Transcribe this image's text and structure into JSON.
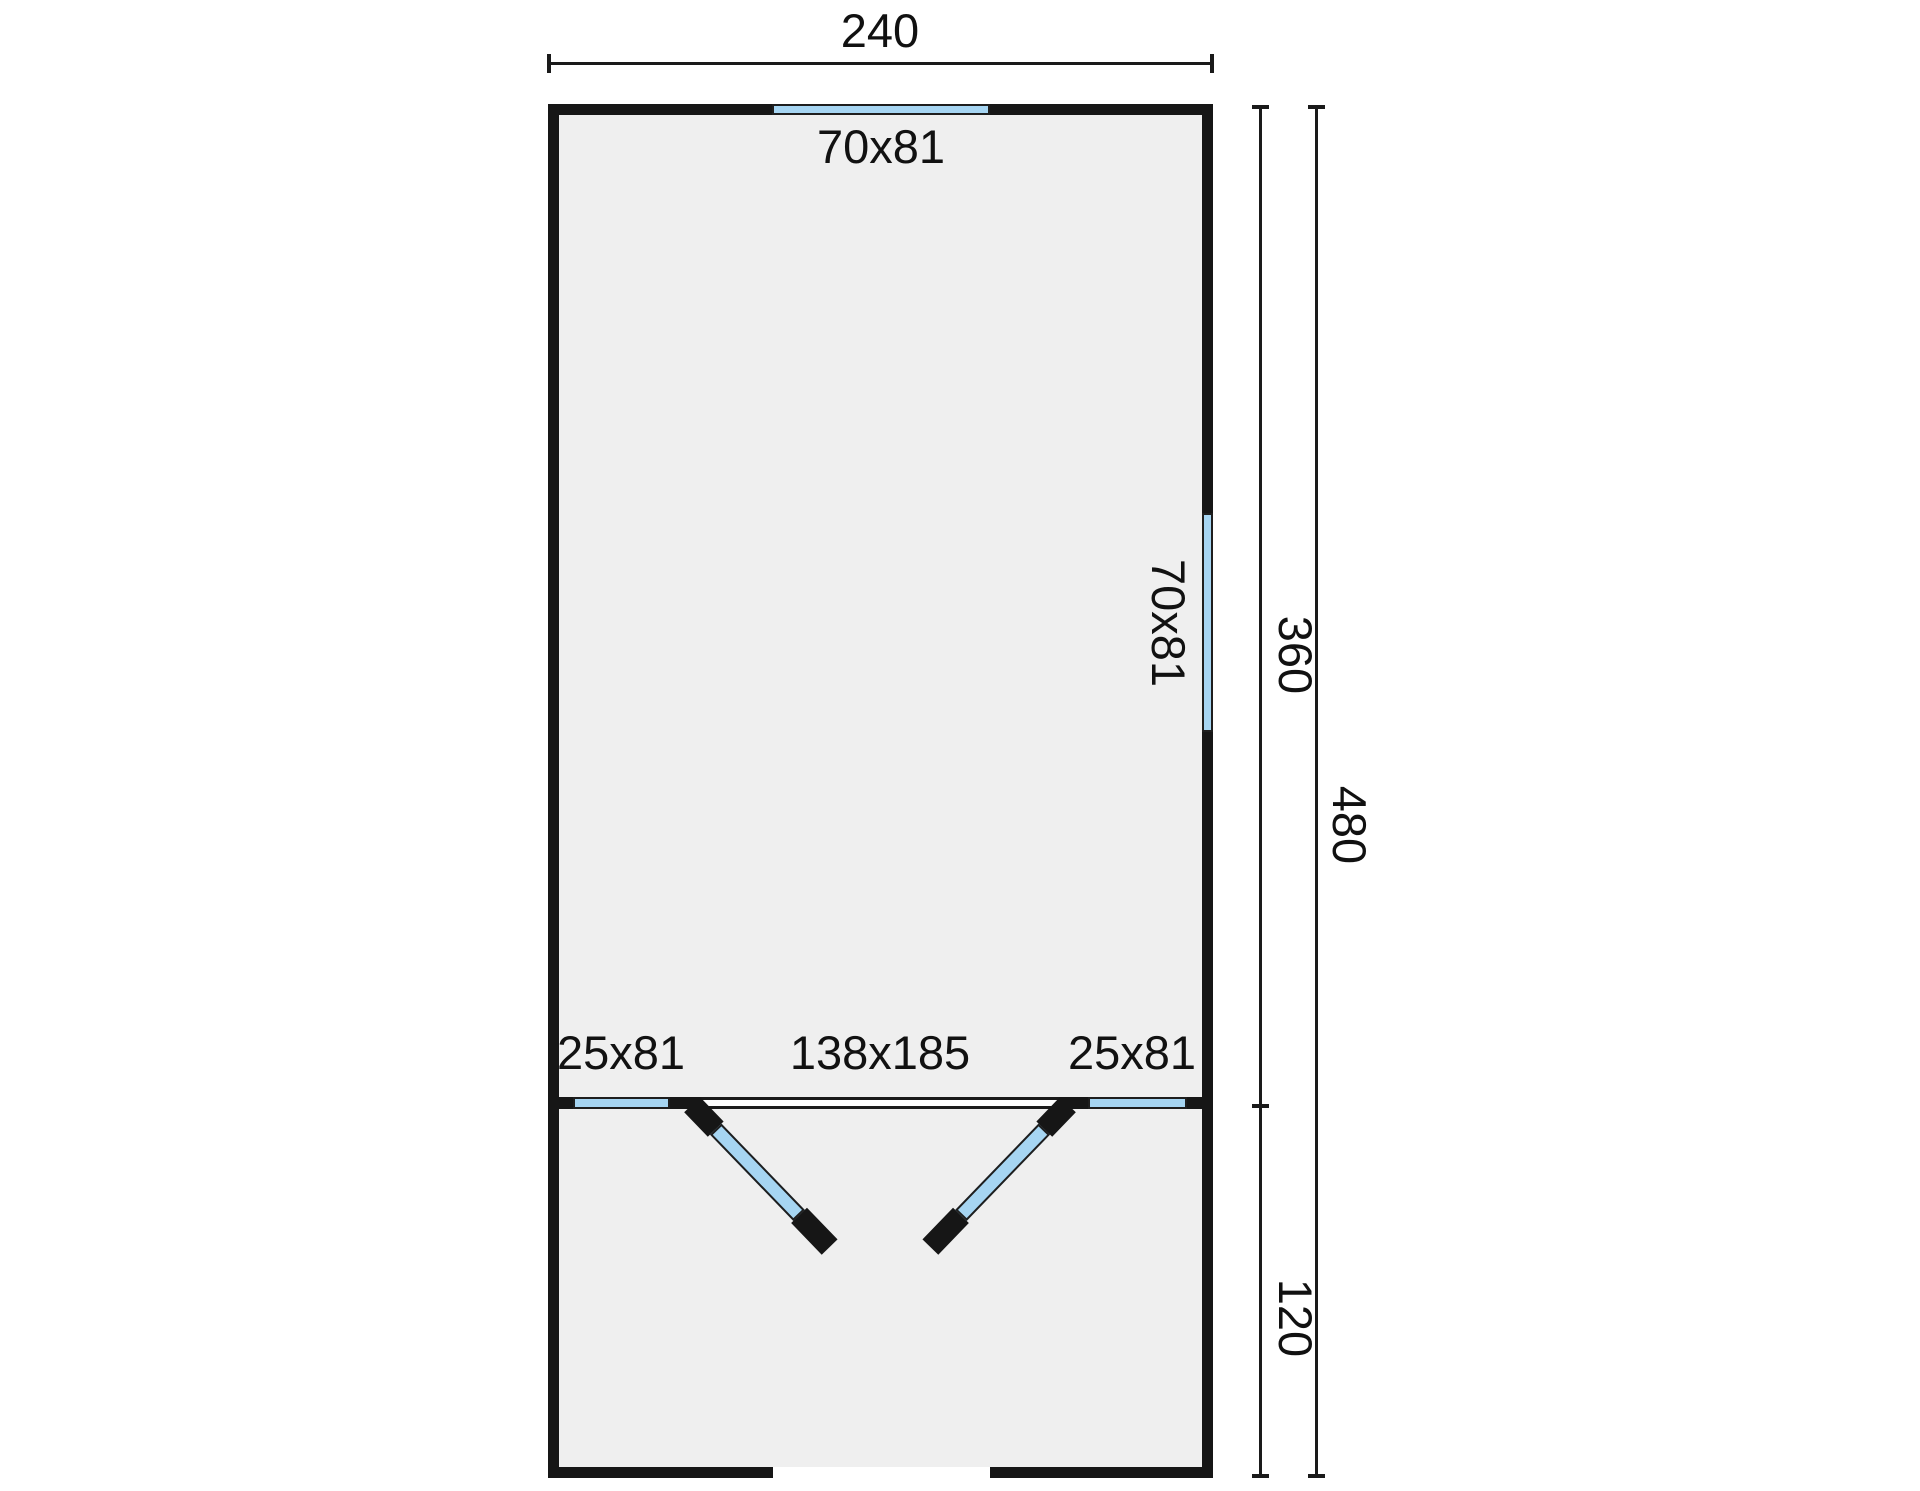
{
  "floorplan": {
    "dim": {
      "width": "240",
      "total_depth": "480",
      "main_depth": "360",
      "porch_depth": "120"
    },
    "windows": {
      "top": "70x81",
      "side": "70x81",
      "porch_left": "25x81",
      "porch_right": "25x81"
    },
    "door": {
      "size": "138x185"
    },
    "colors": {
      "wall": "#161616",
      "window_fill": "#a6d5f2",
      "floor": "#efefef",
      "background": "#ffffff"
    }
  }
}
